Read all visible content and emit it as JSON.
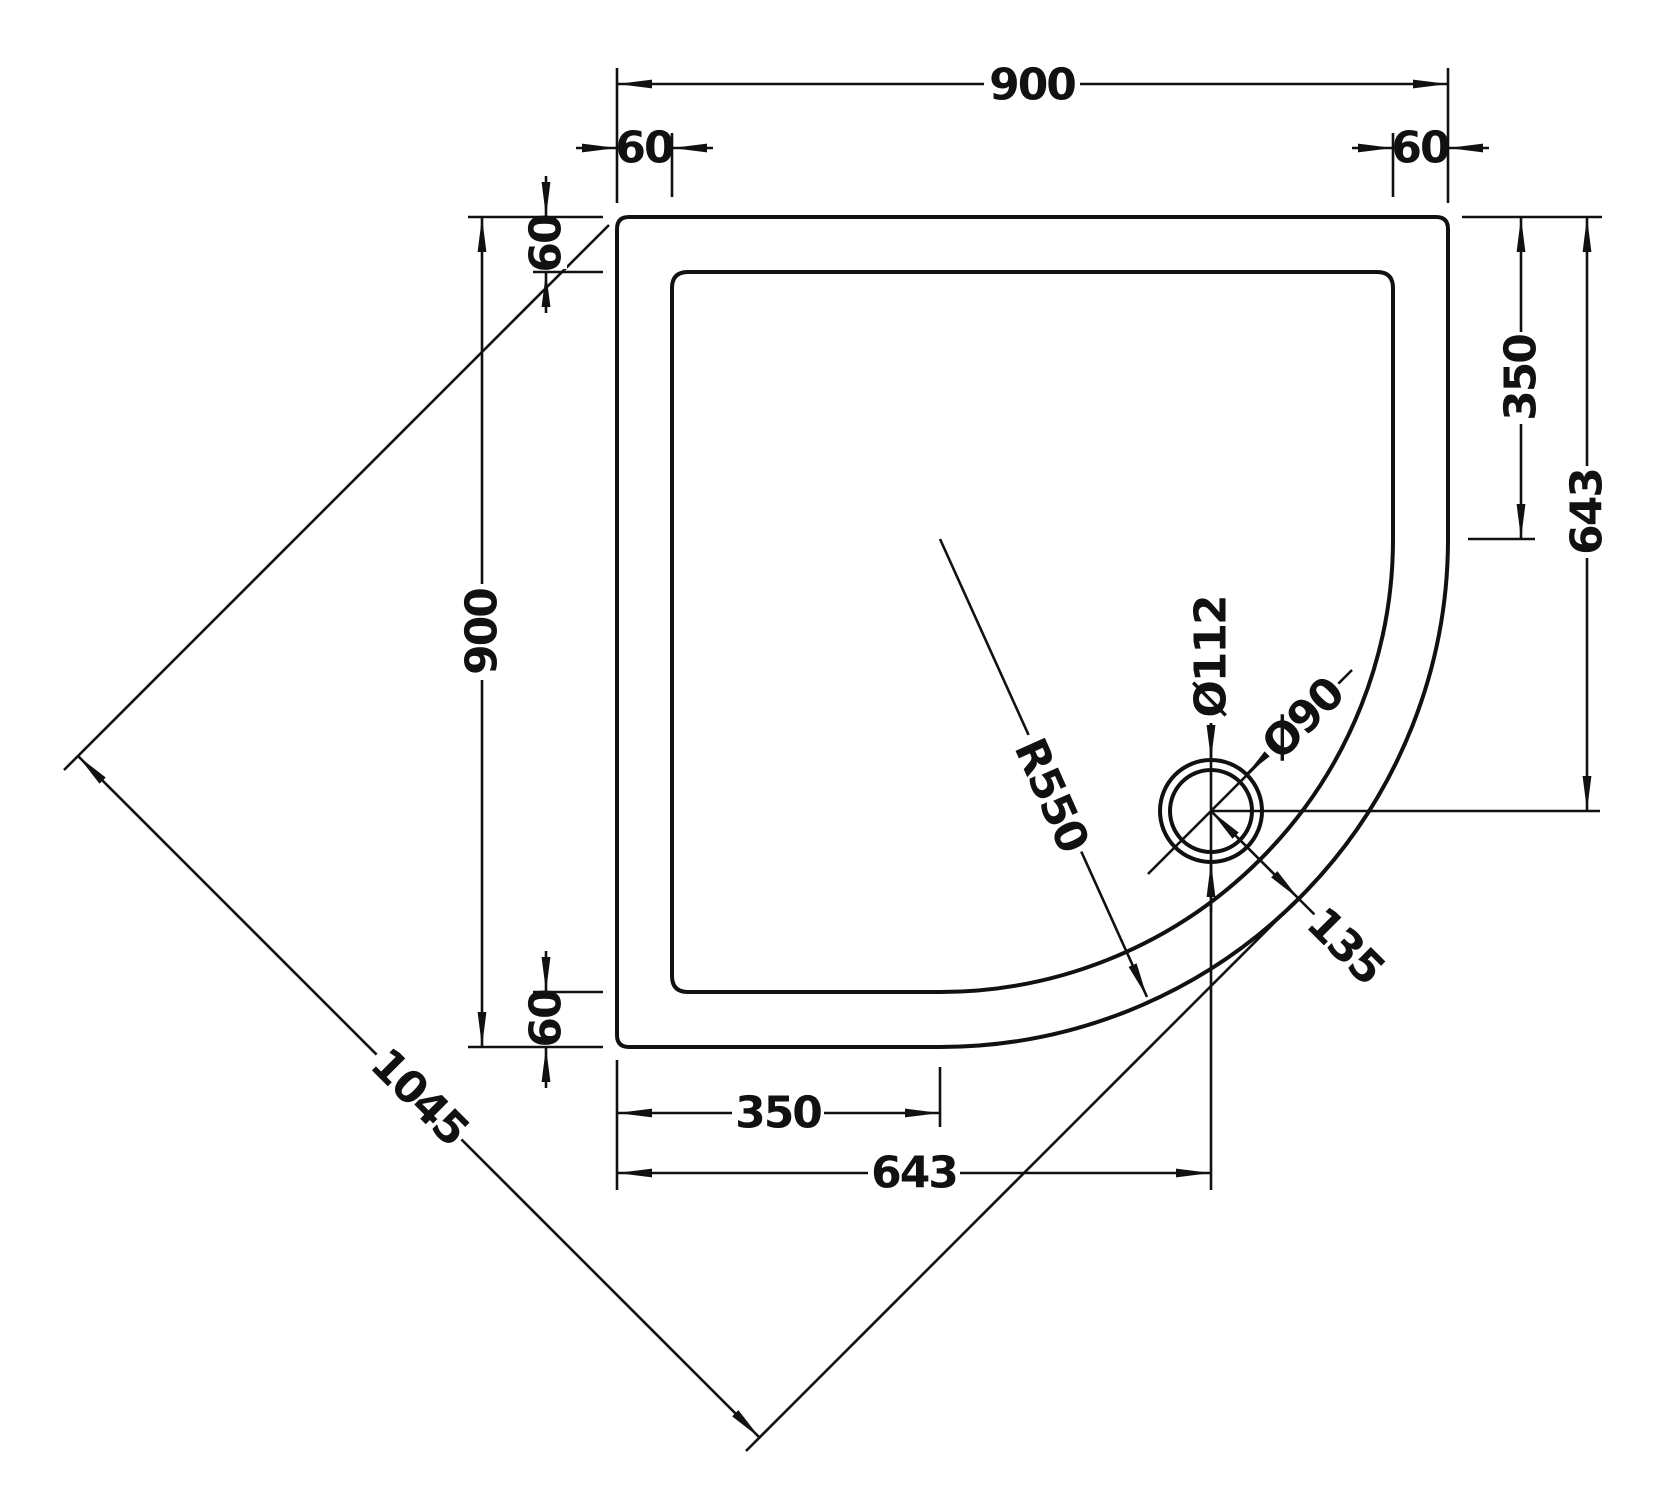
{
  "drawing": {
    "description": "Quadrant shower tray plan-view technical drawing",
    "line_color": "#111111",
    "background_color": "#ffffff",
    "dims": {
      "top_width": "900",
      "top_wall_left": "60",
      "top_wall_right": "60",
      "left_height": "900",
      "left_wall_top": "60",
      "left_wall_bottom": "60",
      "right_arc_offset": "350",
      "right_drain_offset": "643",
      "bottom_arc_offset": "350",
      "bottom_drain_offset": "643",
      "diagonal": "1045",
      "corner_radius": "R550",
      "waste_outer_diameter": "Ø112",
      "waste_inner_diameter": "Ø90",
      "drain_corner_offset": "135"
    }
  }
}
